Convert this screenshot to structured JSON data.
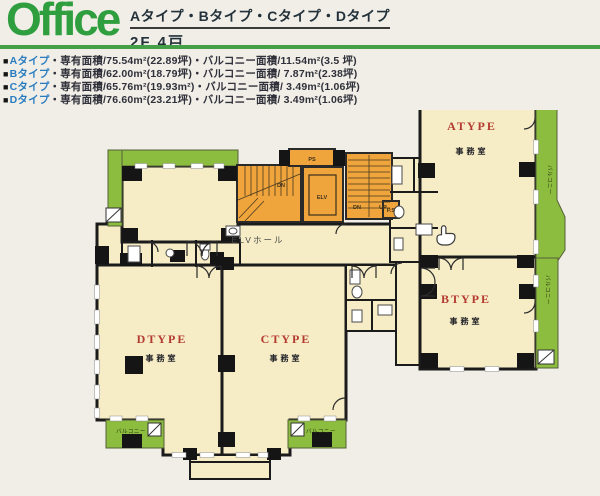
{
  "header": {
    "logo": "Office",
    "title": "Aタイプ・Bタイプ・Cタイプ・Dタイプ",
    "subtitle": "2F 4戸"
  },
  "legend": {
    "items": [
      {
        "marker": "■",
        "type": "Aタイプ",
        "details": "・専有面積/75.54m²(22.89坪)・バルコニー面積/11.54m²(3.5 坪)"
      },
      {
        "marker": "■",
        "type": "Bタイプ",
        "details": "・専有面積/62.00m²(18.79坪)・バルコニー面積/ 7.87m²(2.38坪)"
      },
      {
        "marker": "■",
        "type": "Cタイプ",
        "details": "・専有面積/65.76m²(19.93m²)・バルコニー面積/ 3.49m²(1.06坪)"
      },
      {
        "marker": "■",
        "type": "Dタイプ",
        "details": "・専有面積/76.60m²(23.21坪)・バルコニー面積/ 3.49m²(1.06坪)"
      }
    ]
  },
  "plan": {
    "rooms": {
      "a": {
        "type": "ATYPE",
        "use": "事務室"
      },
      "b": {
        "type": "BTYPE",
        "use": "事務室"
      },
      "c": {
        "type": "CTYPE",
        "use": "事務室"
      },
      "d": {
        "type": "DTYPE",
        "use": "事務室"
      }
    },
    "labels": {
      "elv_hall": "ELVホール",
      "elv": "ELV",
      "ps": "PS",
      "ps_small": "P.S",
      "dn": "DN",
      "up": "UP",
      "balcony": "バルコニー"
    }
  },
  "colors": {
    "paper": "#f0eee7",
    "cream": "#f6edc6",
    "orange": "#efa43c",
    "green": "#8cbd3e",
    "wall": "#1b1b1b",
    "roomlabel": "#b43b31",
    "headergreen": "#2f9e3f",
    "rule": "#43a047",
    "legendblue": "#2a7cc0",
    "text": "#30303a"
  }
}
